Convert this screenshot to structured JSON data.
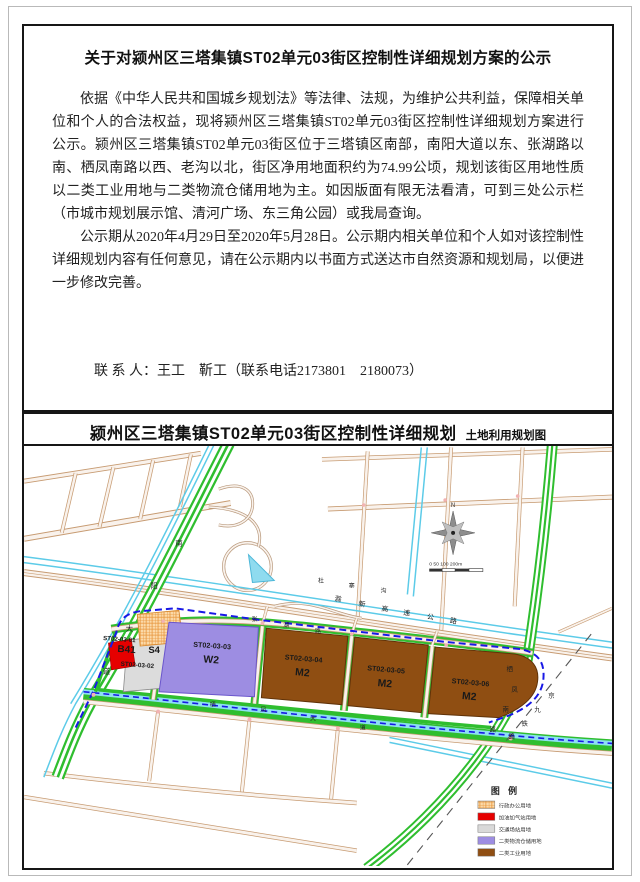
{
  "notice": {
    "title": "关于对颍州区三塔集镇ST02单元03街区控制性详细规划方案的公示",
    "para1": "依据《中华人民共和国城乡规划法》等法律、法规，为维护公共利益，保障相关单位和个人的合法权益，现将颍州区三塔集镇ST02单元03街区控制性详细规划方案进行公示。颍州区三塔集镇ST02单元03街区位于三塔镇区南部，南阳大道以东、张湖路以南、栖凤南路以西、老沟以北，街区净用地面积约为74.99公顷，规划该街区用地性质以二类工业用地与二类物流仓储用地为主。如因版面有限无法看清，可到三处公示栏（市城市规划展示馆、清河广场、东三角公园）或我局查询。",
    "para2": "公示期从2020年4月29日至2020年5月28日。公示期内相关单位和个人如对该控制性详细规划内容有任何意见，请在公示期内以书面方式送达市自然资源和规划局，以便进一步修改完善。",
    "contact_line": "联 系 人：王工　靳工（联系电话2173801　2180073）",
    "address_line": "地　　址：阜阳市自然资源和规划局",
    "website_line": "登陆网址：http://zrgh.fy.gov.cn/",
    "date": "2020年4月29日"
  },
  "map": {
    "header": {
      "title": "颍州区三塔集镇ST02单元03街区控制性详细规划",
      "subtitle": "土地利用规划图"
    },
    "zones": [
      {
        "id": "ST02-03-01",
        "code": "B41",
        "color": "#e60000"
      },
      {
        "id": "ST02-03-02",
        "code": "S4",
        "color": "#dcdcdc"
      },
      {
        "id": "ST02-03-03",
        "code": "W2",
        "color": "#9d8de2"
      },
      {
        "id": "ST02-03-04",
        "code": "M2",
        "color": "#8f4e12"
      },
      {
        "id": "ST02-03-05",
        "code": "M2",
        "color": "#8f4e12"
      },
      {
        "id": "ST02-03-06",
        "code": "M2",
        "color": "#8f4e12"
      }
    ],
    "roads": {
      "nanyang": "南阳大道",
      "expressway": "滁新高速公路",
      "duzhaigou": "杜寨沟",
      "zhanghu": "张湖路",
      "qifeng_south": "栖凤南路",
      "qifeng_avenue": "栖凤大道",
      "railway": "京九铁路"
    },
    "compass": {
      "north": "N"
    },
    "scale": {
      "text": "0  50  100      200m"
    },
    "legend": {
      "title": "图  例",
      "items": [
        {
          "label": "行政办公用地",
          "color": "#f6c38d"
        },
        {
          "label": "加油加气站用地",
          "color": "#e60000"
        },
        {
          "label": "交通场站用地",
          "color": "#d9d9d9"
        },
        {
          "label": "二类物流仓储用地",
          "color": "#9d8de2"
        },
        {
          "label": "二类工业用地",
          "color": "#8f4e12"
        }
      ]
    },
    "boundary_color": "#1818e6"
  }
}
